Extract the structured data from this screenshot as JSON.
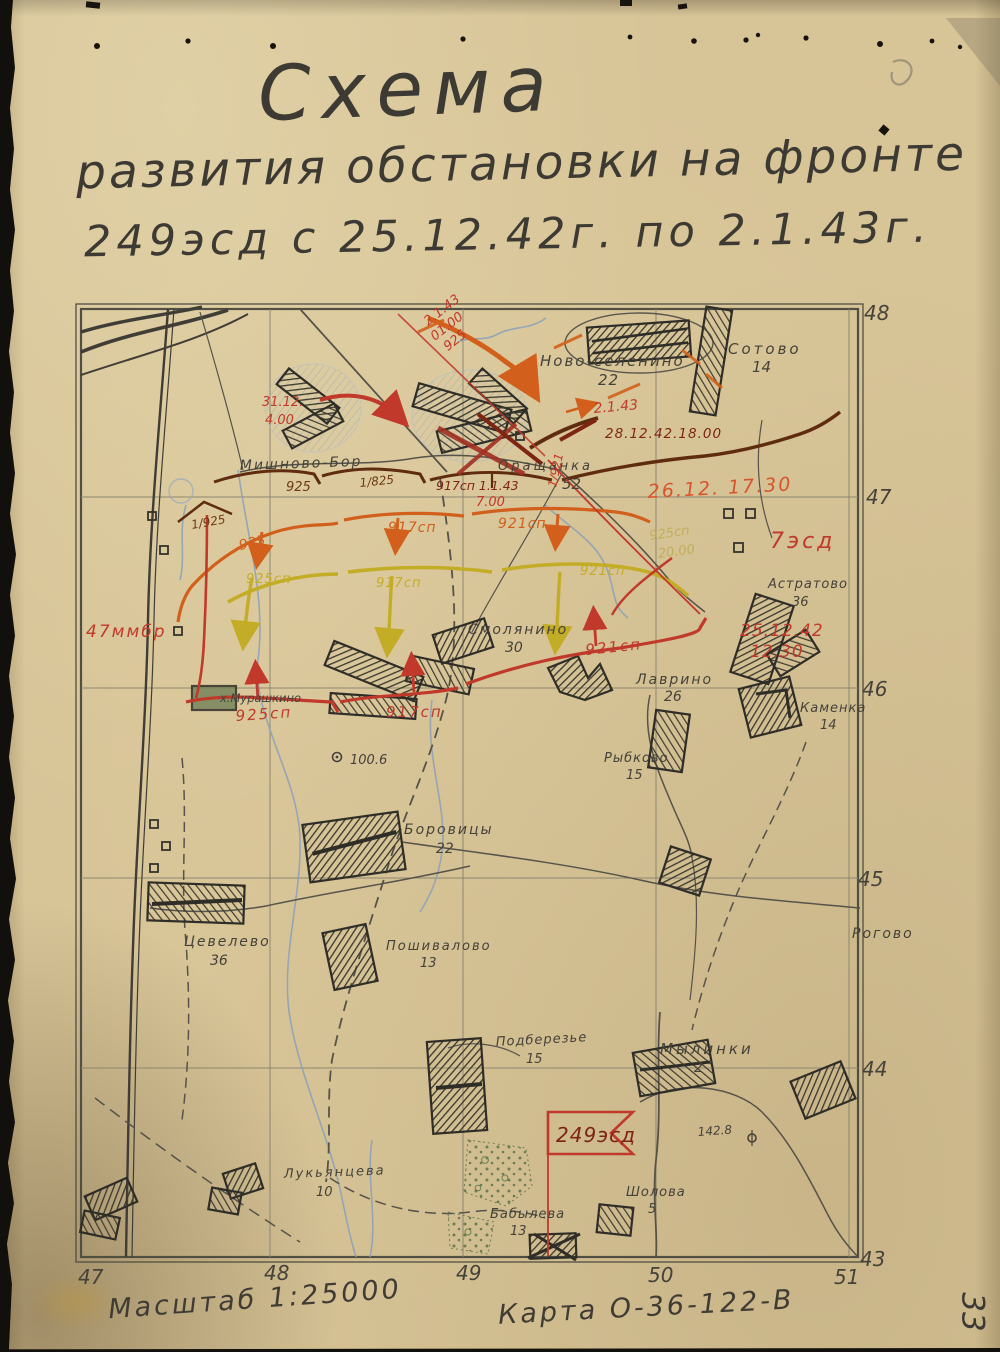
{
  "page": {
    "number": "33"
  },
  "title": {
    "line1": "Схема",
    "line2": "развития обстановки на фронте",
    "line3": "249эсд с 25.12.42г. по 2.1.43г."
  },
  "footer": {
    "scale": "Масштаб 1:25000",
    "map_ref": "Карта О-36-122-В"
  },
  "grid": {
    "right": [
      "48",
      "47",
      "46",
      "45",
      "44",
      "43"
    ],
    "bottom": [
      "47",
      "48",
      "49",
      "50",
      "51"
    ]
  },
  "places": {
    "novoselenino": {
      "name": "Ново-селенино",
      "num": "22"
    },
    "sotovo": {
      "name": "Сотово",
      "num": "14"
    },
    "mishnovo": {
      "name": "Мишново-Бор"
    },
    "orashchanka": {
      "name": "Оращанка",
      "num": "52"
    },
    "astratovo": {
      "name": "Астратово",
      "num": "36"
    },
    "smolyanino": {
      "name": "Смолянино",
      "num": "30"
    },
    "lavrino": {
      "name": "Лаврино",
      "num": "26"
    },
    "kamenka": {
      "name": "Каменка",
      "num": "14"
    },
    "rybkovo": {
      "name": "Рыбково",
      "num": "15"
    },
    "borovitsy": {
      "name": "Боровицы",
      "num": "22"
    },
    "tsevelevo": {
      "name": "Цевелево",
      "num": "36"
    },
    "poshivalovo": {
      "name": "Пошивалово",
      "num": "13"
    },
    "rogovo": {
      "name": "Рогово"
    },
    "podberezye": {
      "name": "Подберезье",
      "num": "15"
    },
    "mylinki": {
      "name": "Мылинки",
      "num": "2"
    },
    "lukyantseva": {
      "name": "Лукьянцева",
      "num": "10"
    },
    "sholova": {
      "name": "Шолова",
      "num": "5"
    },
    "babyleva": {
      "name": "Бабылева",
      "num": "13"
    },
    "murashkino": {
      "name": "х.Мурашкино"
    }
  },
  "heights": {
    "h1": "100.6",
    "h2": "142.8"
  },
  "ann": {
    "a_2143_diag": "2.1.43",
    "a_0100_diag": "01.00",
    "a_925_diag": "925",
    "a_3112": "31.12.",
    "a_400": "4.00",
    "a_2143_mid": "2.1.43",
    "a_281242": "28.12.42.18.00",
    "a_925_brn": "925",
    "a_1825": "1/825",
    "a_917_1143": "917сп 1.1.43",
    "a_700": "7.00",
    "a_1925": "1/925",
    "a_1921": "1/921",
    "a_2612_1730": "26.12. 17.30",
    "a_7esd": "7эсд",
    "a_925_org": "925",
    "a_917_org": "917сп",
    "a_921_org": "921сп",
    "a_925_yel": "925сп",
    "a_917_yel": "917сп",
    "a_921_yel": "921сп",
    "a_925_kha": "925сп",
    "a_2000_kha": "20.00",
    "a_47mmbr": "47ммбр",
    "a_925_red": "925сп",
    "a_917_red": "917сп",
    "a_921_red": "921сп",
    "a_251242": "25.12.42",
    "a_1230": "12.30",
    "a_249esd": "249эсд"
  },
  "palette": {
    "paper": "#d7c497",
    "pencil": "#45423a",
    "red": "#c0392b",
    "dark_red": "#7e2413",
    "brown": "#6e3a12",
    "orange": "#d2601c",
    "yellow": "#c3ad26",
    "water_blue": "#8aa0ba",
    "swamp_green": "#6d7f52"
  }
}
